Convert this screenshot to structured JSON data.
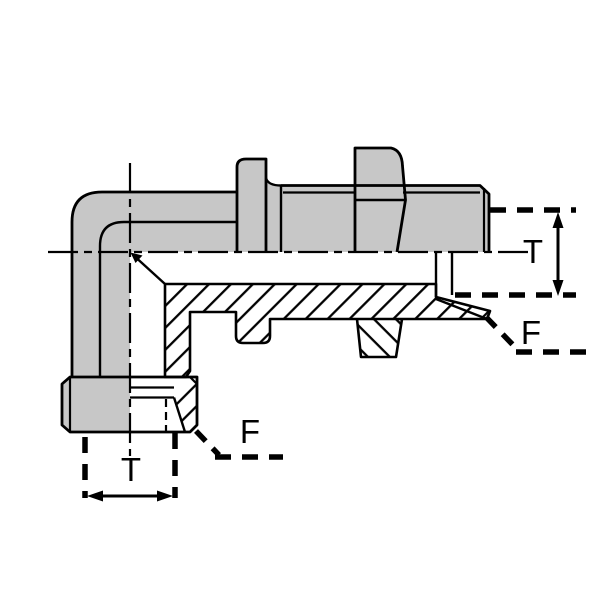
{
  "diagram": {
    "title": "90-degree bulkhead elbow fitting cross-section drawing",
    "labels": {
      "t_right": "T",
      "f_right": "F",
      "f_bottom": "F",
      "t_bottom": "T"
    },
    "colors": {
      "body_fill": "#c7c7c7",
      "line": "#000000",
      "background": "#ffffff"
    }
  }
}
